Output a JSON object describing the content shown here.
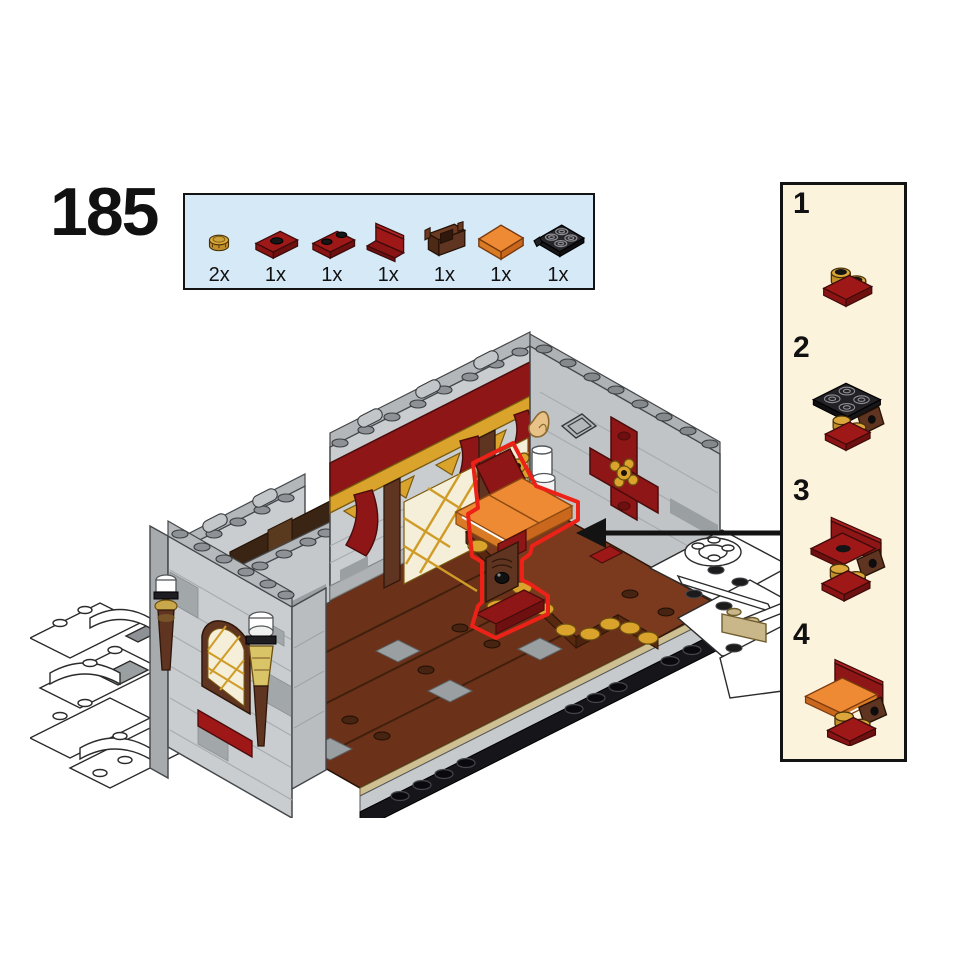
{
  "page": {
    "step_number": "185",
    "background": "#ffffff"
  },
  "parts_callout": {
    "background": "#d6e9f7",
    "border_color": "#131313",
    "parts": [
      {
        "icon": "pearl-gold-round-plate-1x1-icon",
        "count": "2x",
        "color": "#dba73a"
      },
      {
        "icon": "dark-red-plate-1x2-with-stud-icon",
        "count": "1x",
        "color": "#9e1818"
      },
      {
        "icon": "dark-red-plate-1x2-icon",
        "count": "1x",
        "color": "#9e1818"
      },
      {
        "icon": "dark-red-panel-1x2x1-icon",
        "count": "1x",
        "color": "#9e1818"
      },
      {
        "icon": "reddish-brown-bracket-1x2-icon",
        "count": "1x",
        "color": "#5f3420"
      },
      {
        "icon": "orange-tile-2x2-icon",
        "count": "1x",
        "color": "#ee8a33"
      },
      {
        "icon": "black-plate-2x2-modified-icon",
        "count": "1x",
        "color": "#26262a"
      }
    ]
  },
  "substeps_panel": {
    "background": "#fcf3dd",
    "border_color": "#131313",
    "steps": [
      {
        "label": "1"
      },
      {
        "label": "2"
      },
      {
        "label": "3"
      },
      {
        "label": "4"
      }
    ]
  },
  "illustration": {
    "arrow_color": "#131313",
    "highlight_color": "#ec2218",
    "palette": {
      "stone_light": "#c9cdd0",
      "stone_mid": "#b3b7ba",
      "stone_dark": "#a2a7aa",
      "dark_red": "#8e1616",
      "gold": "#d9a32c",
      "reddish_brown": "#5f3420",
      "floor_brown": "#6b3119",
      "orange": "#ee8a33",
      "tan": "#cfc093",
      "pumpkin_red": "#d7281e",
      "leaf_green": "#3e9e3e",
      "candle_white": "#ffffff",
      "flame": "#e8c287",
      "outline_black": "#131313",
      "white": "#ffffff"
    }
  }
}
